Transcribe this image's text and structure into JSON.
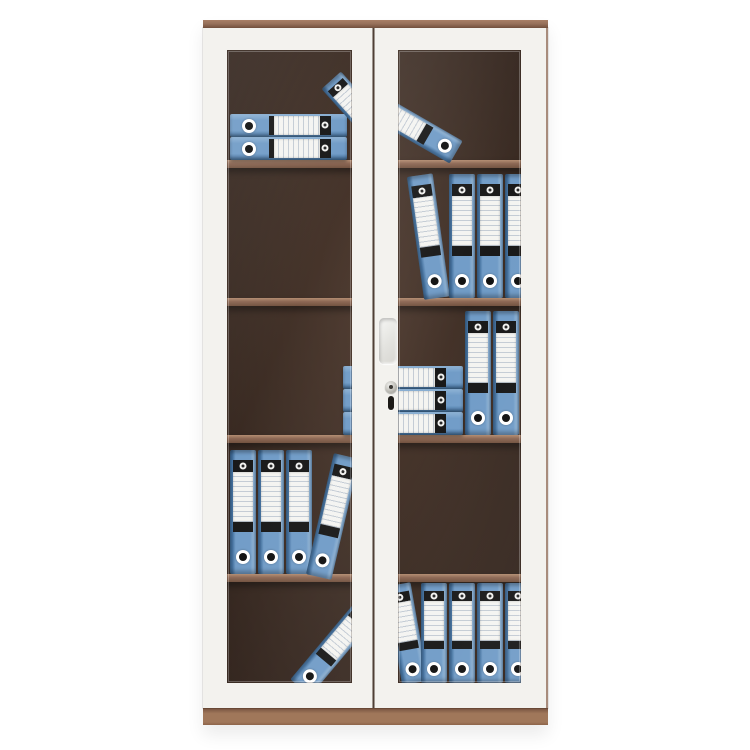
{
  "scene": {
    "kind": "product-photo",
    "subject": "two-door glass filing cabinet with blue lever-arch binders",
    "background_color": "#ffffff"
  },
  "colors": {
    "frame": "#f3f2ee",
    "trim": "#96705a",
    "trim_light": "#a87f66",
    "trim_dark": "#7c5743",
    "plinth": "#a0775a",
    "edge": "#9a7a67",
    "gap": "#4a3a31",
    "interior": "#3a2a21",
    "interior_mid": "#4b372c",
    "interior_deep": "#2a1c15",
    "shelf": "#8a6450",
    "shelf_light": "#b18a6e",
    "shelf_dark": "#6f4f3c",
    "binder_mid": "#6e9ac6",
    "binder_dark": "#3f6e9d",
    "binder_light": "#8db2d5",
    "band": "#141414",
    "label": "#f4f4f1"
  },
  "cabinet": {
    "x": 203,
    "y": 20,
    "w": 345,
    "h": 705,
    "top_strip_h": 8,
    "plinth_y": 688,
    "plinth_h": 17,
    "interior": {
      "x": 14,
      "y": 24,
      "w": 317,
      "h": 645
    },
    "shelf_h": 8,
    "shelves_y": [
      140,
      278,
      415,
      554
    ],
    "doors": [
      {
        "side": "left",
        "x": 0,
        "y": 8,
        "w": 170,
        "h": 680,
        "bt": 22,
        "br": 21,
        "bb": 25,
        "bl": 24
      },
      {
        "side": "right",
        "x": 172,
        "y": 8,
        "w": 173,
        "h": 680,
        "bt": 22,
        "br": 27,
        "bb": 25,
        "bl": 23
      }
    ],
    "windows": [
      {
        "x": 24,
        "y": 30,
        "w": 125,
        "h": 633
      },
      {
        "x": 195,
        "y": 30,
        "w": 123,
        "h": 633
      }
    ],
    "gap": {
      "x": 169,
      "y": 8,
      "w": 3,
      "h": 680
    },
    "edge_right": {
      "x": 343,
      "y": 8,
      "w": 2,
      "h": 680
    },
    "handle": {
      "x": 176,
      "y": 298,
      "w": 18,
      "h": 46
    },
    "lock": {
      "cx": 188,
      "cy": 367,
      "d": 12,
      "slot_x": 185,
      "slot_y": 376,
      "slot_w": 6,
      "slot_h": 14
    }
  },
  "binders": [
    {
      "t": "h",
      "x": 27,
      "y": 94,
      "w": 117,
      "h": 23
    },
    {
      "t": "h",
      "x": 27,
      "y": 117,
      "w": 117,
      "h": 23
    },
    {
      "t": "v",
      "x": 142,
      "y": 50,
      "w": 26,
      "h": 80,
      "rot": -42
    },
    {
      "t": "v",
      "x": 199,
      "y": 61,
      "w": 26,
      "h": 95,
      "rot": -60
    },
    {
      "t": "v",
      "x": 221,
      "y": 154,
      "w": 26,
      "h": 124,
      "rot": -8,
      "org": "50% 100%"
    },
    {
      "t": "v",
      "x": 246,
      "y": 154,
      "w": 26,
      "h": 124
    },
    {
      "t": "v",
      "x": 274,
      "y": 154,
      "w": 26,
      "h": 124
    },
    {
      "t": "v",
      "x": 302,
      "y": 154,
      "w": 26,
      "h": 124
    },
    {
      "t": "h",
      "x": 140,
      "y": 346,
      "w": 120,
      "h": 23
    },
    {
      "t": "h",
      "x": 140,
      "y": 369,
      "w": 120,
      "h": 23
    },
    {
      "t": "h",
      "x": 140,
      "y": 392,
      "w": 120,
      "h": 23
    },
    {
      "t": "v",
      "x": 262,
      "y": 291,
      "w": 26,
      "h": 124
    },
    {
      "t": "v",
      "x": 290,
      "y": 291,
      "w": 26,
      "h": 124
    },
    {
      "t": "v",
      "x": 27,
      "y": 430,
      "w": 26,
      "h": 124
    },
    {
      "t": "v",
      "x": 55,
      "y": 430,
      "w": 26,
      "h": 124
    },
    {
      "t": "v",
      "x": 83,
      "y": 430,
      "w": 26,
      "h": 124
    },
    {
      "t": "v",
      "x": 103,
      "y": 430,
      "w": 26,
      "h": 124,
      "rot": 13,
      "org": "0% 100%"
    },
    {
      "t": "v",
      "x": 118,
      "y": 575,
      "w": 26,
      "h": 105,
      "rot": 40
    },
    {
      "t": "v",
      "x": 199,
      "y": 563,
      "w": 26,
      "h": 100,
      "rot": -10,
      "org": "50% 100%"
    },
    {
      "t": "v",
      "x": 218,
      "y": 563,
      "w": 26,
      "h": 100
    },
    {
      "t": "v",
      "x": 246,
      "y": 563,
      "w": 26,
      "h": 100
    },
    {
      "t": "v",
      "x": 274,
      "y": 563,
      "w": 26,
      "h": 100
    },
    {
      "t": "v",
      "x": 302,
      "y": 563,
      "w": 26,
      "h": 100
    }
  ]
}
